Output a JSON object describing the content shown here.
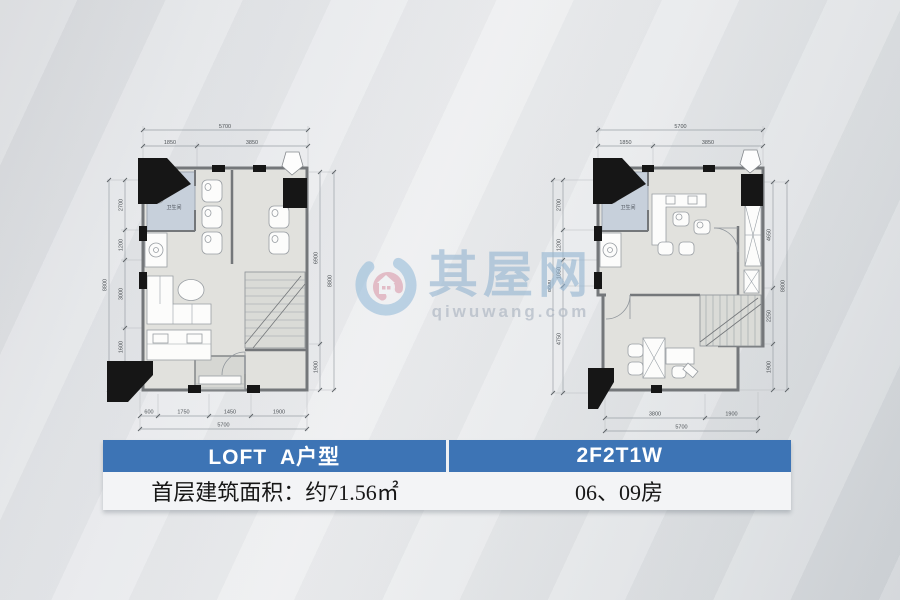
{
  "watermark": {
    "brand": "其屋网",
    "url": "qiwuwang.com"
  },
  "table": {
    "header_left": "LOFT  A户型",
    "header_right": "2F2T1W",
    "row_left": "首层建筑面积：约71.56㎡",
    "row_right": "06、09房",
    "header_bg": "#3d74b5"
  },
  "colors": {
    "wall": "#74777a",
    "bathroom_fill": "#c7d0db",
    "room_fill": "#e1e1dd",
    "watermark_blue": "#94b5d1",
    "watermark_pink": "#d893a4"
  },
  "plans": {
    "left": {
      "bathroom_label": "卫生间",
      "dims": {
        "top_total": "5700",
        "top": [
          "1850",
          "3850"
        ],
        "bottom": [
          "600",
          "1750",
          "1450",
          "1900"
        ],
        "bottom_total": "5700",
        "left": [
          "2700",
          "1200",
          "3000",
          "1600",
          "900"
        ],
        "left_total": "8800",
        "right": [
          "6900",
          "1900"
        ],
        "right_total": "8800"
      }
    },
    "right": {
      "bathroom_label": "卫生间",
      "dims": {
        "top_total": "5700",
        "top": [
          "1850",
          "3850"
        ],
        "bottom": [
          "3800",
          "1900"
        ],
        "bottom_total": "5700",
        "left": [
          "2700",
          "1200",
          "1050",
          "4750"
        ],
        "left_total": "8800",
        "right": [
          "4650",
          "2250",
          "1900"
        ],
        "right_total": "8800"
      }
    }
  }
}
